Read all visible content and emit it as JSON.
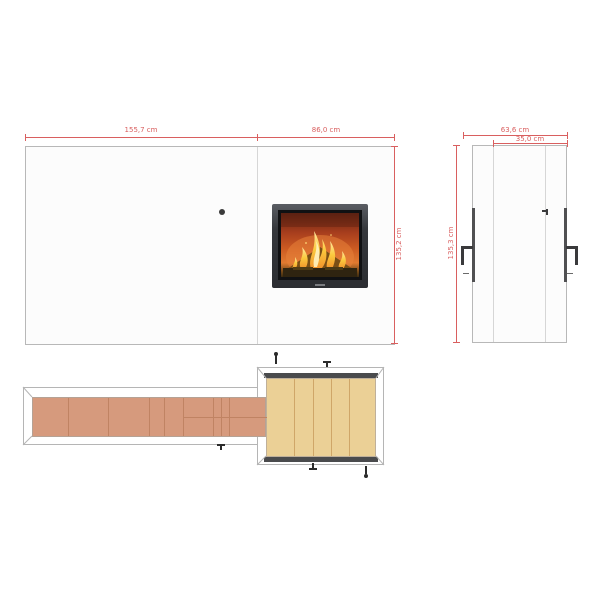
{
  "title": "fireplace-technical-drawing",
  "front_view": {
    "dim_width_left": "155,7 cm",
    "dim_width_right": "86,0 cm",
    "dim_height": "135,2 cm"
  },
  "side_view": {
    "dim_depth": "63,6 cm",
    "dim_depth_inner": "35,0 cm",
    "dim_height": "135,3 cm"
  },
  "plan_view": {
    "bench_plank_count": 8,
    "hearth_plank_count": 5
  },
  "colors": {
    "dimension_red": "#d95f5f",
    "outline_gray": "#b5b5b5",
    "panel_white": "#fcfcfc",
    "bench_wood_terracotta": "#d69a7d",
    "hearth_wood_tan": "#ebd096",
    "insert_frame_dark": "#3d3f44",
    "strip_dark": "#4a4b4d",
    "flame_yellow": "#f8c43c",
    "fire_orange": "#d2561f"
  }
}
